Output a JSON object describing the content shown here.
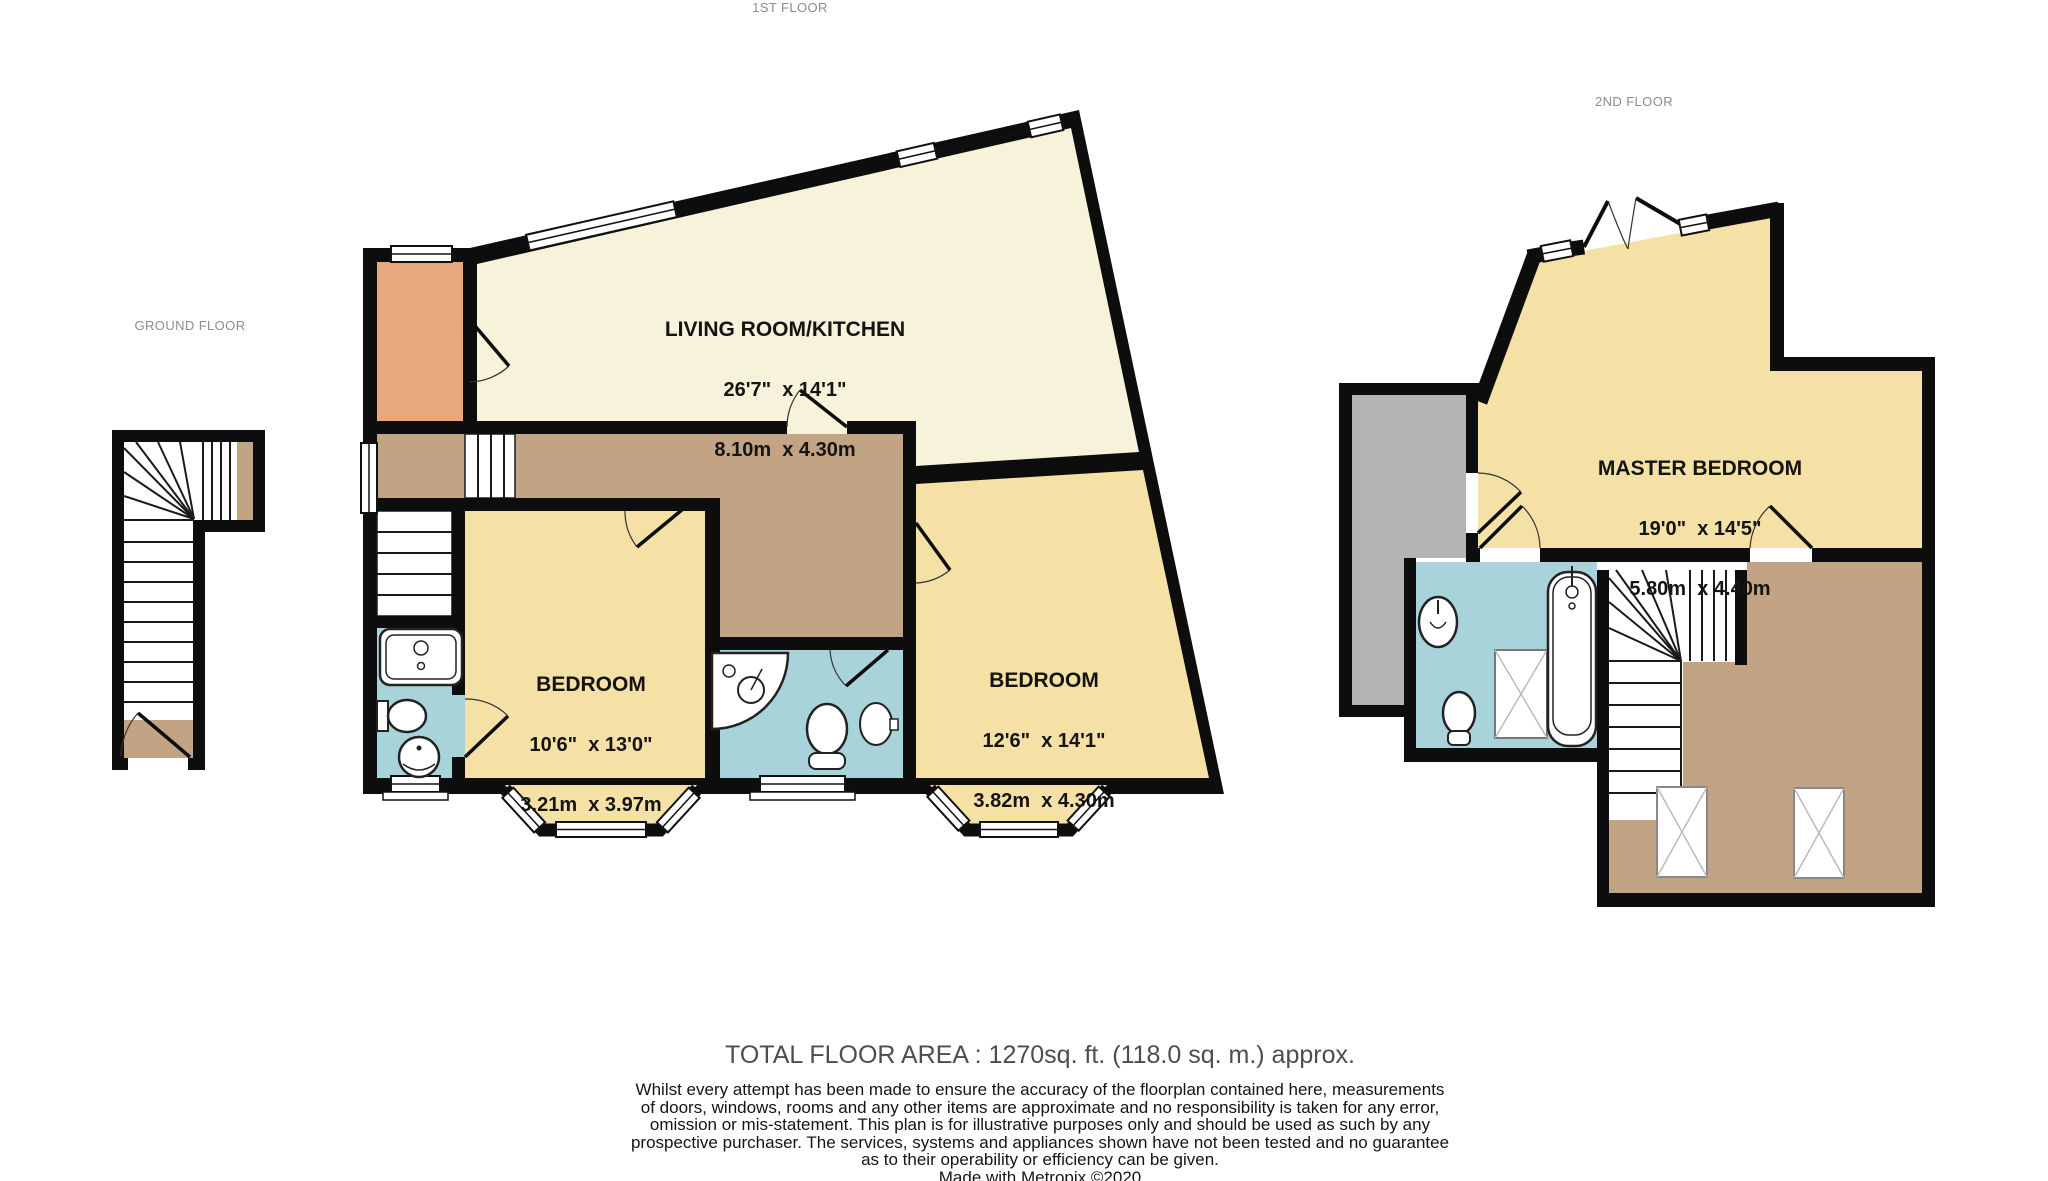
{
  "floors": {
    "ground": {
      "label": "GROUND FLOOR"
    },
    "first": {
      "label": "1ST FLOOR"
    },
    "second": {
      "label": "2ND FLOOR"
    }
  },
  "rooms": {
    "living_room": {
      "name": "LIVING ROOM/KITCHEN",
      "imperial": "26'7\"  x 14'1\"",
      "metric": "8.10m  x 4.30m"
    },
    "bedroom_1": {
      "name": "BEDROOM",
      "imperial": "10'6\"  x 13'0\"",
      "metric": "3.21m  x 3.97m"
    },
    "bedroom_2": {
      "name": "BEDROOM",
      "imperial": "12'6\"  x 14'1\"",
      "metric": "3.82m  x 4.30m"
    },
    "master_bedroom": {
      "name": "MASTER BEDROOM",
      "imperial": "19'0\"  x 14'5\"",
      "metric": "5.80m  x 4.40m"
    }
  },
  "footer": {
    "total_area": "TOTAL FLOOR AREA : 1270sq. ft. (118.0 sq. m.) approx.",
    "disclaimer": "Whilst every attempt has been made to ensure the accuracy of the floorplan contained here, measurements\nof doors, windows, rooms and any other items are approximate and no responsibility is taken for any error,\nomission or mis-statement. This plan is for illustrative purposes only and should be used as such by any\nprospective purchaser. The services, systems and appliances shown have not been tested and no guarantee\nas to their operability or efficiency can be given.",
    "credit": "Made with Metropix ©2020"
  },
  "colors": {
    "wall": "#0d0d0d",
    "living_cream": "#F7F2DA",
    "bedroom_yellow": "#F5E1A6",
    "hallway_tan": "#C2A383",
    "entrance_orange": "#E8A87D",
    "bathroom_blue": "#A8D3DA",
    "void_gray": "#B4B4B4",
    "label_gray": "#8c8c8c",
    "footer_gray": "#4d4d4d"
  }
}
